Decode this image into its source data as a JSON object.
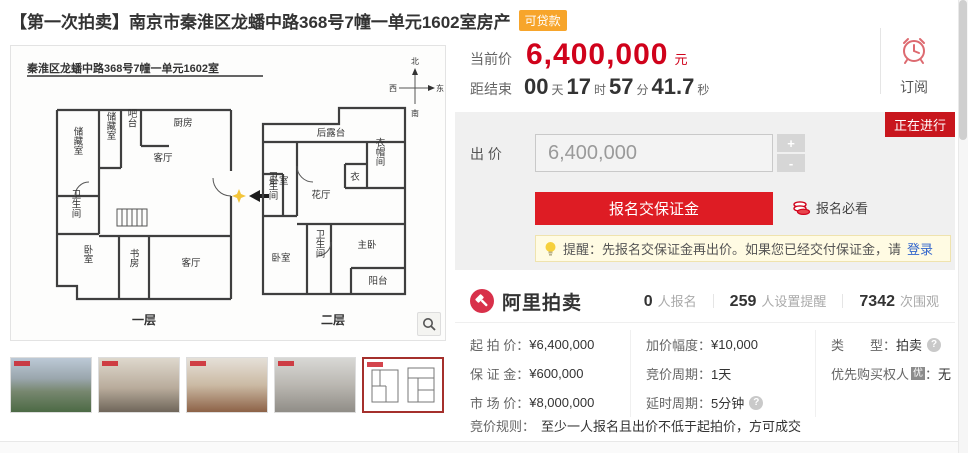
{
  "header": {
    "title": "【第一次拍卖】南京市秦淮区龙蟠中路368号7幢一单元1602室房产",
    "badge": "可贷款"
  },
  "price": {
    "label": "当前价",
    "value": "6,400,000",
    "unit": "元"
  },
  "countdown": {
    "label": "距结束",
    "days": "00",
    "days_unit": "天",
    "hours": "17",
    "hours_unit": "时",
    "minutes": "57",
    "minutes_unit": "分",
    "seconds": "41.7",
    "seconds_unit": "秒"
  },
  "subscribe": {
    "label": "订阅"
  },
  "status_badge": "正在进行",
  "bid": {
    "label": "出 价",
    "value": "6,400,000",
    "submit_label": "报名交保证金",
    "notice_label": "报名必看"
  },
  "icons": {
    "plus": "+",
    "minus": "-",
    "help": "?"
  },
  "tip": {
    "text": "提醒：先报名交保证金再出价。如果您已经交付保证金，请",
    "link": "登录"
  },
  "stats": {
    "brand": "阿里拍卖",
    "items": [
      {
        "value": "0",
        "label": "人报名"
      },
      {
        "value": "259",
        "label": "人设置提醒"
      },
      {
        "value": "7342",
        "label": "次围观"
      }
    ]
  },
  "details": {
    "col1": [
      {
        "label": "起 拍 价：",
        "value": "¥6,400,000"
      },
      {
        "label": "保 证 金：",
        "value": "¥600,000"
      },
      {
        "label": "市 场 价：",
        "value": "¥8,000,000"
      }
    ],
    "col2": [
      {
        "label": "加价幅度：",
        "value": "¥10,000"
      },
      {
        "label": "竞价周期：",
        "value": "1天"
      },
      {
        "label": "延时周期：",
        "value": "5分钟"
      }
    ],
    "col3": [
      {
        "label": "类　　型：",
        "value": "拍卖"
      },
      {
        "label": "优先购买权人",
        "badge": "优",
        "colon": "：",
        "value": "无"
      }
    ],
    "rule": {
      "label": "竞价规则：",
      "value": "至少一人报名且出价不低于起拍价，方可成交"
    }
  },
  "floorplan": {
    "title": "秦淮区龙蟠中路368号7幢一单元1602室",
    "compass": {
      "n": "北",
      "s": "南",
      "w": "西",
      "e": "东"
    },
    "floor1": {
      "caption": "一层",
      "rooms": [
        "储藏室",
        "储藏室",
        "吧台",
        "厨房",
        "客厅",
        "卫生间",
        "卧室",
        "书房",
        "客厅"
      ]
    },
    "floor2": {
      "caption": "二层",
      "rooms": [
        "后露台",
        "卧室",
        "花厅",
        "衣帽间",
        "衣",
        "卫生间",
        "卧室",
        "卫生间",
        "主卧",
        "阳台"
      ]
    }
  },
  "colors": {
    "accent_red": "#d0021b",
    "button_red": "#de1c24",
    "status_red": "#c8161d",
    "badge_orange": "#f7a52b"
  }
}
